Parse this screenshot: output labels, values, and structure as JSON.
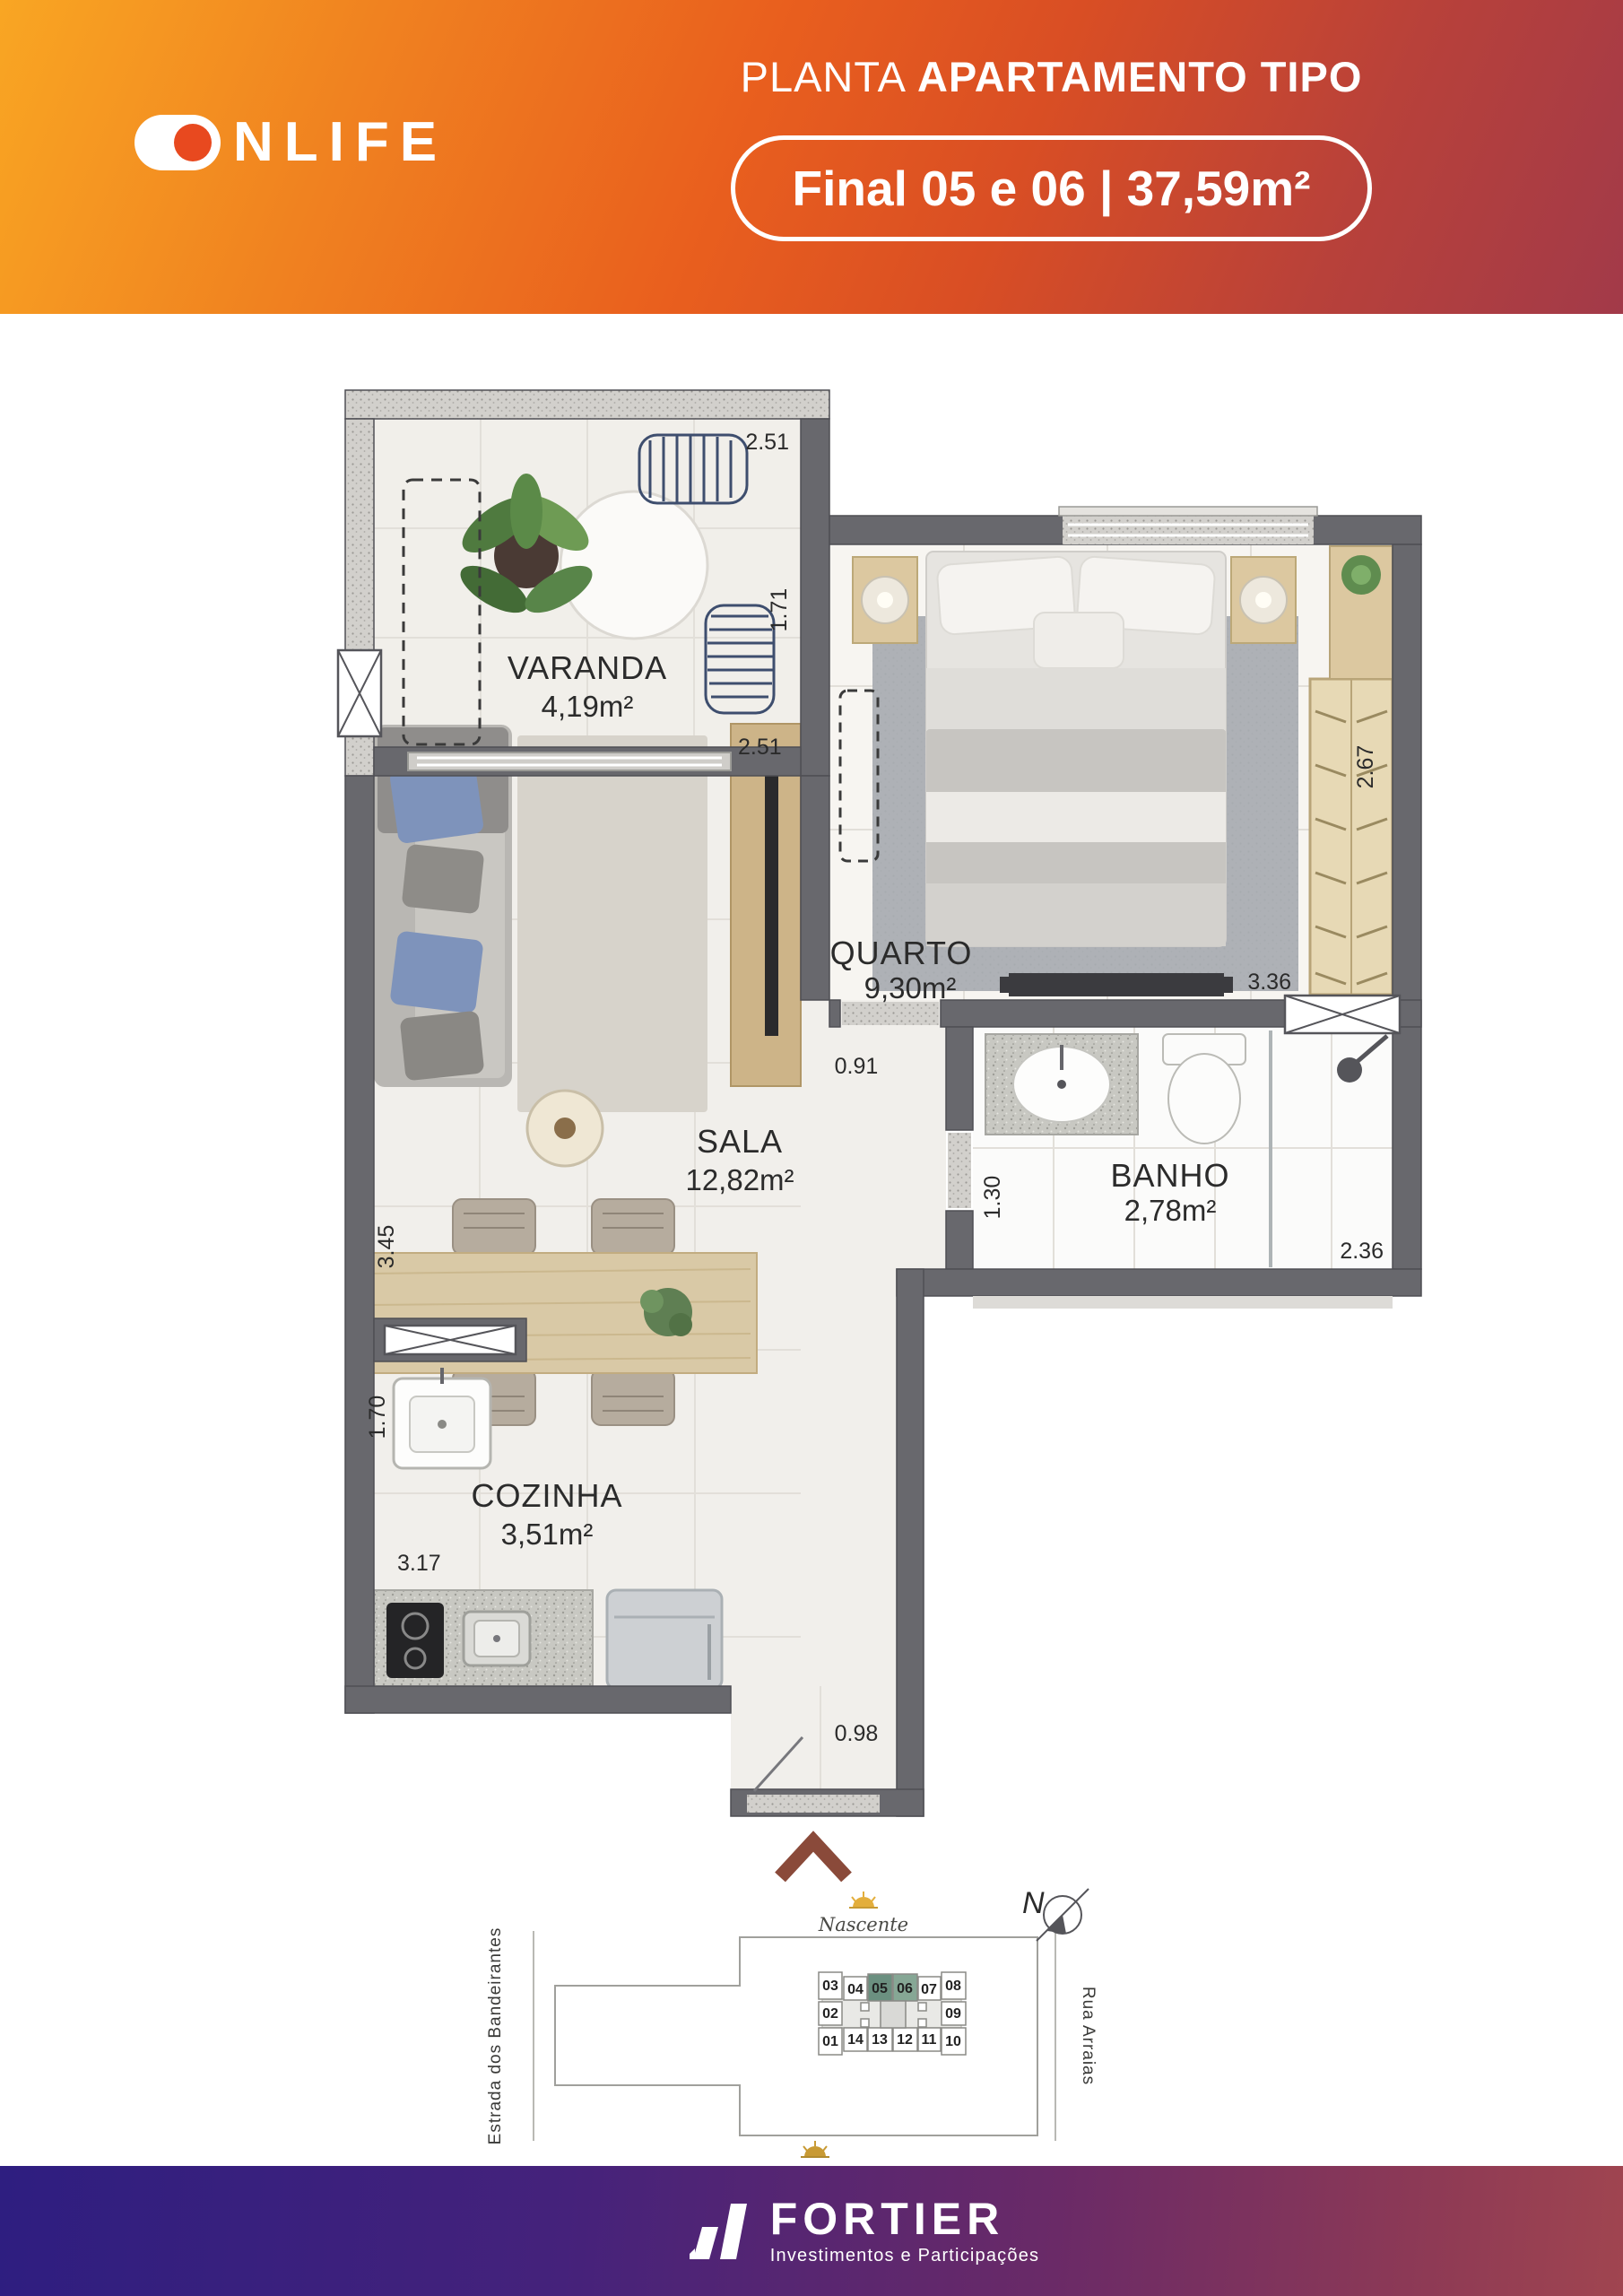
{
  "header": {
    "brand_o": "",
    "brand_rest": "NLIFE",
    "title": {
      "light": "PLANTA",
      "bold": "APARTAMENTO TIPO"
    },
    "badge": "Final 05 e 06  |  37,59m²"
  },
  "plan": {
    "rooms": {
      "varanda": {
        "name": "VARANDA",
        "area": "4,19m²"
      },
      "quarto": {
        "name": "QUARTO",
        "area": "9,30m²"
      },
      "sala": {
        "name": "SALA",
        "area": "12,82m²"
      },
      "banho": {
        "name": "BANHO",
        "area": "2,78m²"
      },
      "cozinha": {
        "name": "COZINHA",
        "area": "3,51m²"
      }
    },
    "dims": {
      "varanda_w": "2.51",
      "varanda_d": "1.71",
      "sala_w": "2.51",
      "sala_h": "3.45",
      "quarto_w": "3.36",
      "quarto_d": "2.67",
      "hall_door": "0.91",
      "banho_d": "1.30",
      "banho_w": "2.36",
      "cozinha_d": "1.70",
      "cozinha_w": "3.17",
      "entry_w": "0.98"
    }
  },
  "siteplan": {
    "north": "N",
    "nascente": "Nascente",
    "poente": "Poente",
    "street_left": "Estrada dos Bandeirantes",
    "street_right": "Rua Arraias",
    "units_top": [
      "03",
      "04",
      "05",
      "06",
      "07",
      "08"
    ],
    "unit_left": "02",
    "unit_right": "09",
    "units_bottom": [
      "01",
      "14",
      "13",
      "12",
      "11",
      "10"
    ]
  },
  "footer": {
    "brand": "FORTIER",
    "tagline": "Investimentos e Participações"
  }
}
